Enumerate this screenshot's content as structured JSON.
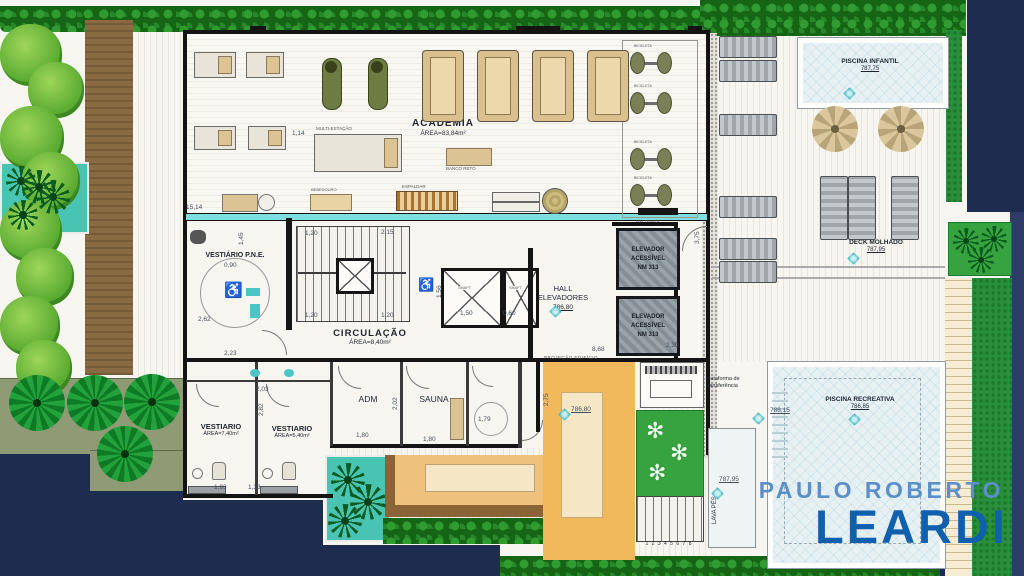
{
  "logo": {
    "line1": "PAULO ROBERTO",
    "line2": "LEARDI",
    "color1": "#5b8fc9",
    "color2": "#1160ae"
  },
  "rooms": {
    "academia": {
      "name": "ACADEMIA",
      "area": "ÁREA=83,84m²"
    },
    "vestiario_pne": {
      "name": "VESTIÁRIO P.N.E."
    },
    "circulacao": {
      "name": "CIRCULAÇÃO",
      "area": "ÁREA=8,40m²"
    },
    "hall": {
      "l1": "HALL",
      "l2": "ELEVADORES",
      "level": "786,80"
    },
    "elevador": {
      "l1": "ELEVADOR",
      "l2": "ACESSÍVEL",
      "l3": "NM 313"
    },
    "adm": {
      "name": "ADM"
    },
    "sauna": {
      "name": "SAUNA"
    },
    "vestiario_1": {
      "name": "VESTIARIO",
      "area": "ÁREA=7,40m²"
    },
    "vestiario_2": {
      "name": "VESTIARIO",
      "area": "ÁREA=5,40m²"
    },
    "projecao": {
      "name": "PROJEÇÃO EDIFÍCIO"
    }
  },
  "outdoor": {
    "piscina_infantil": {
      "name": "PISCINA INFANTIL",
      "level": "787,75"
    },
    "deck_molhado": {
      "name": "DECK MOLHADO",
      "level": "787,95"
    },
    "piscina_recreativa": {
      "name": "PISCINA RECREATIVA",
      "level": "786,85"
    },
    "lava_pes": {
      "name": "LAVA PÉS"
    },
    "plataforma": {
      "l1": "plataforma de",
      "l2": "transferência"
    },
    "stair_numbers": "1 2 3 4 5 6 7 8"
  },
  "equipment": {
    "bicicleta": "BICICLETA",
    "multi_estacao": "MULTI-ESTAÇÃO",
    "banco_reto": "BANCO RETO",
    "espaldar": "ESPALDAR",
    "bebedouro": "BEBEDOURO",
    "halteres": "HALTERES",
    "shaft": "SHAFT"
  },
  "icons": {
    "wheelchair": "♿"
  },
  "dims": [
    {
      "t": "15,14",
      "x": 186,
      "y": 205
    },
    {
      "t": "1,14",
      "x": 292,
      "y": 131
    },
    {
      "t": "1,20",
      "x": 305,
      "y": 231
    },
    {
      "t": "2,15",
      "x": 381,
      "y": 230
    },
    {
      "t": "1,20",
      "x": 305,
      "y": 313
    },
    {
      "t": "1,20",
      "x": 381,
      "y": 313
    },
    {
      "t": "0,90",
      "x": 224,
      "y": 263
    },
    {
      "t": "2,62",
      "x": 198,
      "y": 317
    },
    {
      "t": "2,23",
      "x": 224,
      "y": 351
    },
    {
      "t": "1,45",
      "x": 239,
      "y": 245,
      "v": 1
    },
    {
      "t": "1,50",
      "x": 460,
      "y": 311
    },
    {
      "t": "0,60",
      "x": 503,
      "y": 311
    },
    {
      "t": "1,56",
      "x": 437,
      "y": 298,
      "v": 1
    },
    {
      "t": "3,75",
      "x": 695,
      "y": 244,
      "v": 1
    },
    {
      "t": "2,30",
      "x": 666,
      "y": 343
    },
    {
      "t": "8,68",
      "x": 592,
      "y": 347
    },
    {
      "t": "2,03",
      "x": 256,
      "y": 387
    },
    {
      "t": "2,82",
      "x": 259,
      "y": 416,
      "v": 1
    },
    {
      "t": "1,93",
      "x": 214,
      "y": 485
    },
    {
      "t": "1,33",
      "x": 248,
      "y": 485
    },
    {
      "t": "1,80",
      "x": 356,
      "y": 433
    },
    {
      "t": "1,80",
      "x": 423,
      "y": 437
    },
    {
      "t": "2,02",
      "x": 393,
      "y": 410,
      "v": 1
    },
    {
      "t": "1,79",
      "x": 478,
      "y": 417
    },
    {
      "t": "2,75",
      "x": 544,
      "y": 406,
      "v": 1
    },
    {
      "t": "788,15",
      "x": 770,
      "y": 408,
      "u": 1
    },
    {
      "t": "786,80",
      "x": 571,
      "y": 407,
      "u": 1
    },
    {
      "t": "787,95",
      "x": 719,
      "y": 477,
      "u": 1
    }
  ],
  "sparkles": [
    [
      551,
      307
    ],
    [
      560,
      410
    ],
    [
      845,
      89
    ],
    [
      849,
      254
    ],
    [
      850,
      415
    ],
    [
      754,
      414
    ],
    [
      713,
      489
    ]
  ],
  "decor": {
    "bushes": [
      [
        0,
        24,
        62
      ],
      [
        28,
        62,
        56
      ],
      [
        0,
        106,
        64
      ],
      [
        22,
        152,
        58
      ],
      [
        0,
        200,
        62
      ],
      [
        16,
        248,
        58
      ],
      [
        0,
        296,
        60
      ],
      [
        16,
        340,
        56
      ]
    ],
    "swirls": [
      [
        9,
        375
      ],
      [
        67,
        375
      ],
      [
        124,
        374
      ],
      [
        97,
        426
      ]
    ],
    "palms": [
      [
        6,
        166,
        30
      ],
      [
        36,
        180,
        34
      ],
      [
        8,
        200,
        30
      ],
      [
        22,
        170,
        34
      ],
      [
        331,
        463,
        34
      ],
      [
        350,
        484,
        36
      ],
      [
        328,
        504,
        34
      ],
      [
        953,
        228,
        26
      ],
      [
        981,
        226,
        26
      ],
      [
        968,
        247,
        26
      ]
    ],
    "flowers": [
      [
        646,
        420
      ],
      [
        670,
        442
      ],
      [
        648,
        462
      ]
    ],
    "parasols": [
      [
        812,
        106
      ],
      [
        878,
        106
      ]
    ],
    "loungers_right_y": [
      36,
      60,
      114,
      196,
      238,
      261
    ],
    "loungers_deck_x": [
      820,
      848,
      891
    ],
    "treadmill_x": [
      422,
      477,
      532,
      587
    ],
    "bike_y": [
      50,
      90,
      146,
      182
    ]
  }
}
